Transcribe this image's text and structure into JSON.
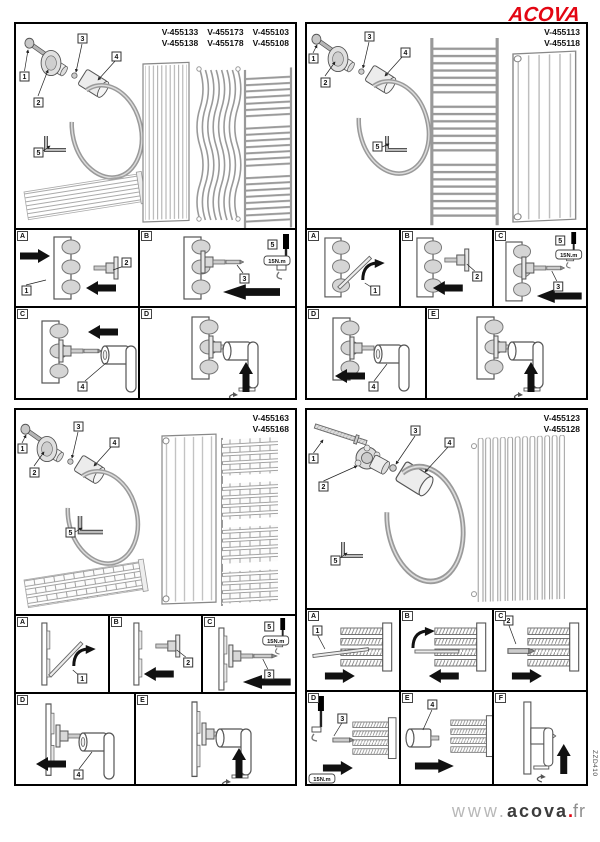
{
  "brand": {
    "logo_text": "ACOVA",
    "logo_color": "#e30613"
  },
  "footer": {
    "prefix": "www.",
    "brand": "acova",
    "dot": ".",
    "tld": "fr"
  },
  "doc_code": "ZZD410",
  "torque_label": "15N.m",
  "callouts": {
    "n1": "1",
    "n2": "2",
    "n3": "3",
    "n4": "4",
    "n5": "5"
  },
  "panels": [
    {
      "name": "top-left",
      "part_numbers": [
        [
          "V-455133",
          "V-455173",
          "V-455103"
        ],
        [
          "V-455138",
          "V-455178",
          "V-455108"
        ]
      ],
      "steps": [
        "A",
        "B",
        "C",
        "D"
      ]
    },
    {
      "name": "top-right",
      "part_numbers": [
        [
          "V-455113"
        ],
        [
          "V-455118"
        ]
      ],
      "steps": [
        "A",
        "B",
        "C",
        "D",
        "E"
      ]
    },
    {
      "name": "bottom-left",
      "part_numbers": [
        [
          "V-455163"
        ],
        [
          "V-455168"
        ]
      ],
      "steps": [
        "A",
        "B",
        "C",
        "D",
        "E"
      ]
    },
    {
      "name": "bottom-right",
      "part_numbers": [
        [
          "V-455123"
        ],
        [
          "V-455128"
        ]
      ],
      "steps": [
        "A",
        "B",
        "C",
        "D",
        "E",
        "F"
      ]
    }
  ]
}
